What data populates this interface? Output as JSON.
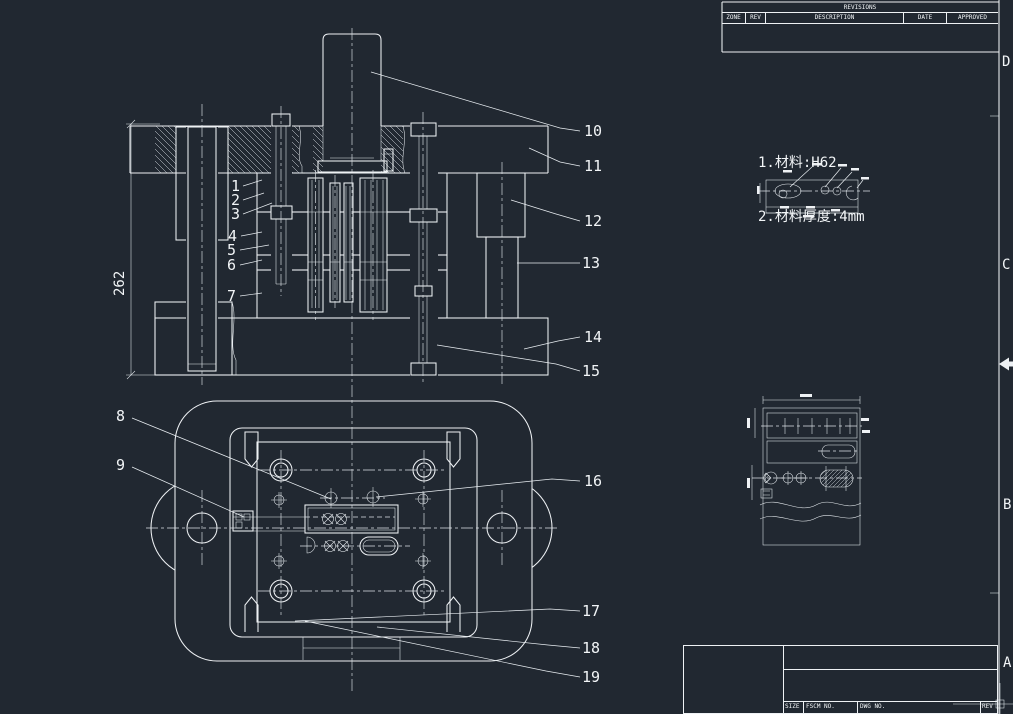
{
  "colors": {
    "background": "#212831",
    "line": "#eef1f4"
  },
  "notes": {
    "line1": "1.材料:H62",
    "line2": "2.材料厚度:4mm"
  },
  "dimension_262": "262",
  "part_labels": [
    "1",
    "2",
    "3",
    "4",
    "5",
    "6",
    "7",
    "8",
    "9",
    "10",
    "11",
    "12",
    "13",
    "14",
    "15",
    "16",
    "17",
    "18",
    "19"
  ],
  "revisions_table": {
    "title": "REVISIONS",
    "columns": [
      "ZONE",
      "REV",
      "DESCRIPTION",
      "DATE",
      "APPROVED"
    ]
  },
  "title_block": {
    "size_label": "SIZE",
    "fscm_label": "FSCM NO.",
    "dwg_label": "DWG NO.",
    "rev_label": "REV"
  },
  "zone_markers": [
    "D",
    "C",
    "B",
    "A"
  ]
}
